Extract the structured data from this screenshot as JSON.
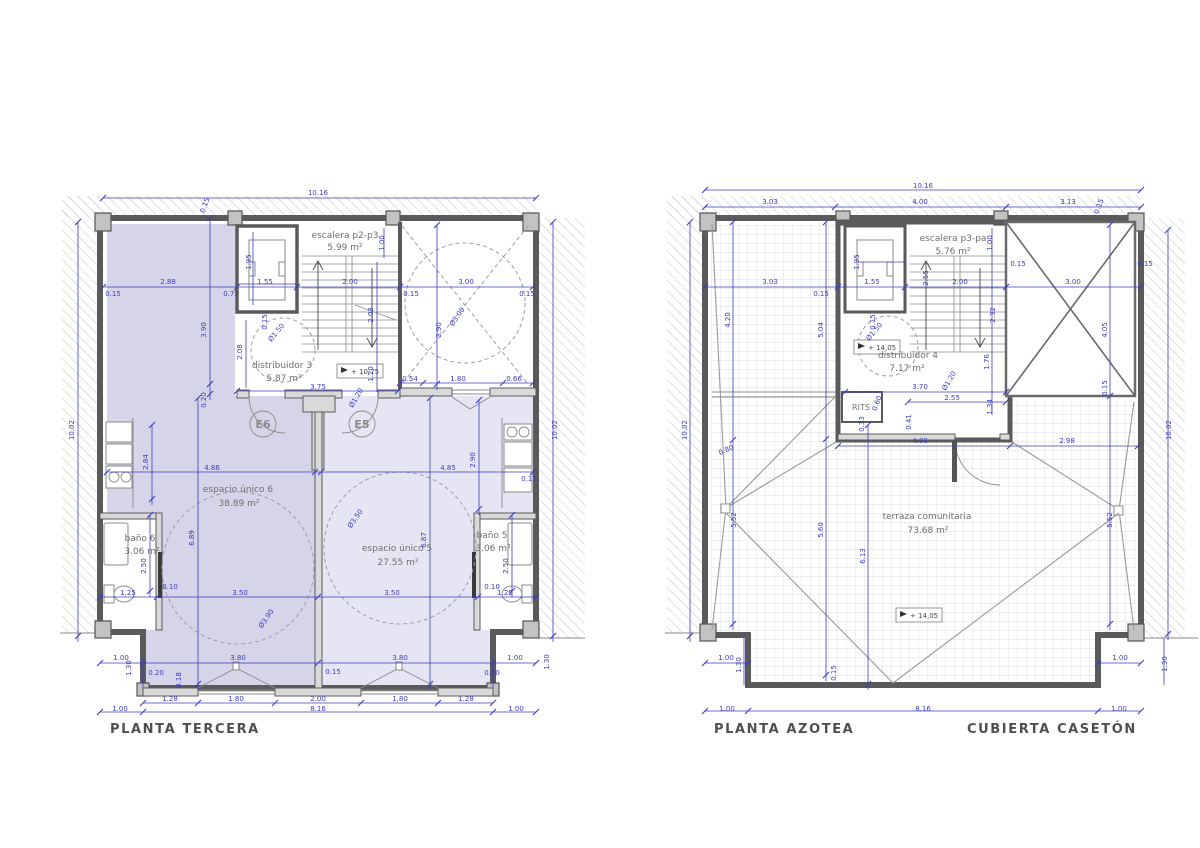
{
  "titles": {
    "left": "PLANTA TERCERA",
    "right": "PLANTA AZOTEA",
    "right2": "CUBIERTA CASETÓN"
  },
  "colors": {
    "dimension": "#3c3cc0",
    "wall": "#5a5a5a",
    "room_fill_6": "#d6d4e9",
    "room_fill_5": "#e6e5f3"
  },
  "plans": {
    "left": {
      "rooms": [
        {
          "name": "escalera p2-p3",
          "area": "5.99 m²"
        },
        {
          "name": "distribuidor 3",
          "area": "5.87 m²"
        },
        {
          "name": "espacio único 6",
          "area": "38.89 m²"
        },
        {
          "name": "espacio único 5",
          "area": "27.55 m²"
        },
        {
          "name": "baño 6",
          "area": "3.06 m²"
        },
        {
          "name": "baño 5",
          "area": "3.06 m²"
        }
      ],
      "doors": [
        {
          "label": "E6"
        },
        {
          "label": "E5"
        }
      ],
      "level_marker": "+ 10,75",
      "dims": [
        {
          "t": "10.16",
          "x": 318,
          "y": 195
        },
        {
          "t": "0.15",
          "x": 207,
          "y": 206,
          "r": -70
        },
        {
          "t": "2.88",
          "x": 168,
          "y": 284
        },
        {
          "t": "0.15",
          "x": 113,
          "y": 296
        },
        {
          "t": "1.55",
          "x": 265,
          "y": 284
        },
        {
          "t": "0.75",
          "x": 231,
          "y": 296
        },
        {
          "t": "1.95",
          "x": 251,
          "y": 262,
          "r": -90
        },
        {
          "t": "0.15",
          "x": 267,
          "y": 322,
          "r": -90
        },
        {
          "t": "2.00",
          "x": 350,
          "y": 284
        },
        {
          "t": "3.00",
          "x": 466,
          "y": 284
        },
        {
          "t": "0.15",
          "x": 527,
          "y": 296
        },
        {
          "t": "0.15",
          "x": 411,
          "y": 296
        },
        {
          "t": "1.00",
          "x": 384,
          "y": 243,
          "r": -90
        },
        {
          "t": "3.90",
          "x": 206,
          "y": 330,
          "r": -90
        },
        {
          "t": "0.20",
          "x": 206,
          "y": 400,
          "r": -90
        },
        {
          "t": "3.90",
          "x": 441,
          "y": 330,
          "r": -90
        },
        {
          "t": "2.03",
          "x": 373,
          "y": 315,
          "r": -90
        },
        {
          "t": "2.08",
          "x": 242,
          "y": 352,
          "r": -90
        },
        {
          "t": "Ø1.50",
          "x": 278,
          "y": 334,
          "r": -50
        },
        {
          "t": "Ø3.00",
          "x": 459,
          "y": 318,
          "r": -55
        },
        {
          "t": "3.75",
          "x": 318,
          "y": 389
        },
        {
          "t": "1.20",
          "x": 373,
          "y": 374,
          "r": -90
        },
        {
          "t": "Ø1.20",
          "x": 358,
          "y": 399,
          "r": -60
        },
        {
          "t": "0.54",
          "x": 410,
          "y": 381
        },
        {
          "t": "1.80",
          "x": 458,
          "y": 381
        },
        {
          "t": "0.66",
          "x": 514,
          "y": 381
        },
        {
          "t": "10.02",
          "x": 74,
          "y": 430,
          "r": -90
        },
        {
          "t": "10.02",
          "x": 557,
          "y": 430,
          "r": -90
        },
        {
          "t": "2.84",
          "x": 148,
          "y": 462,
          "r": -90
        },
        {
          "t": "2.90",
          "x": 475,
          "y": 460,
          "r": -90
        },
        {
          "t": "4.86",
          "x": 212,
          "y": 470
        },
        {
          "t": "4.85",
          "x": 448,
          "y": 470
        },
        {
          "t": "0.15",
          "x": 529,
          "y": 481
        },
        {
          "t": "6.89",
          "x": 194,
          "y": 538,
          "r": -90
        },
        {
          "t": "6.87",
          "x": 426,
          "y": 540,
          "r": -90
        },
        {
          "t": "Ø3.50",
          "x": 357,
          "y": 520,
          "r": -55
        },
        {
          "t": "Ø3.90",
          "x": 268,
          "y": 620,
          "r": -55
        },
        {
          "t": "2.50",
          "x": 146,
          "y": 566,
          "r": -90
        },
        {
          "t": "2.50",
          "x": 508,
          "y": 566,
          "r": -90
        },
        {
          "t": "0.10",
          "x": 170,
          "y": 589
        },
        {
          "t": "0.10",
          "x": 492,
          "y": 589
        },
        {
          "t": "1.25",
          "x": 128,
          "y": 595
        },
        {
          "t": "1.25",
          "x": 505,
          "y": 595
        },
        {
          "t": "3.50",
          "x": 240,
          "y": 595
        },
        {
          "t": "3.50",
          "x": 392,
          "y": 595
        },
        {
          "t": "1.00",
          "x": 121,
          "y": 660
        },
        {
          "t": "3.80",
          "x": 238,
          "y": 660
        },
        {
          "t": "3.80",
          "x": 400,
          "y": 660
        },
        {
          "t": "1.00",
          "x": 515,
          "y": 660
        },
        {
          "t": "0.20",
          "x": 156,
          "y": 675
        },
        {
          "t": "0.18",
          "x": 181,
          "y": 680,
          "r": -90
        },
        {
          "t": "0.15",
          "x": 333,
          "y": 674
        },
        {
          "t": "0.20",
          "x": 492,
          "y": 675
        },
        {
          "t": "1.30",
          "x": 131,
          "y": 668,
          "r": -90
        },
        {
          "t": "1.30",
          "x": 549,
          "y": 662,
          "r": -90
        },
        {
          "t": "1.28",
          "x": 170,
          "y": 701
        },
        {
          "t": "1.80",
          "x": 236,
          "y": 701
        },
        {
          "t": "2.00",
          "x": 318,
          "y": 701
        },
        {
          "t": "1.80",
          "x": 400,
          "y": 701
        },
        {
          "t": "1.28",
          "x": 466,
          "y": 701
        },
        {
          "t": "1.00",
          "x": 120,
          "y": 711
        },
        {
          "t": "8.16",
          "x": 318,
          "y": 711
        },
        {
          "t": "1.00",
          "x": 516,
          "y": 711
        }
      ]
    },
    "right": {
      "rooms": [
        {
          "name": "escalera p3-pa",
          "area": "5.76 m²"
        },
        {
          "name": "distribuidor 4",
          "area": "7.17 m²"
        },
        {
          "name": "RITS",
          "area": ""
        },
        {
          "name": "terraza comunitaria",
          "area": "73.68 m²"
        }
      ],
      "level_marker": "+ 14,05",
      "level_marker_2": "+ 14,05",
      "dims": [
        {
          "t": "10.16",
          "x": 923,
          "y": 188
        },
        {
          "t": "3.03",
          "x": 770,
          "y": 204
        },
        {
          "t": "4.00",
          "x": 920,
          "y": 204
        },
        {
          "t": "3.13",
          "x": 1068,
          "y": 204
        },
        {
          "t": "0.15",
          "x": 1101,
          "y": 207,
          "r": -70
        },
        {
          "t": "3.03",
          "x": 770,
          "y": 284
        },
        {
          "t": "0.15",
          "x": 821,
          "y": 296
        },
        {
          "t": "1.55",
          "x": 872,
          "y": 284
        },
        {
          "t": "1.95",
          "x": 859,
          "y": 262,
          "r": -90
        },
        {
          "t": "0.15",
          "x": 875,
          "y": 322,
          "r": -90
        },
        {
          "t": "2.00",
          "x": 960,
          "y": 284
        },
        {
          "t": "2.55",
          "x": 928,
          "y": 278,
          "r": -90
        },
        {
          "t": "1.00",
          "x": 992,
          "y": 243,
          "r": -90
        },
        {
          "t": "0.15",
          "x": 1018,
          "y": 266
        },
        {
          "t": "3.00",
          "x": 1073,
          "y": 284
        },
        {
          "t": "0.15",
          "x": 1145,
          "y": 266
        },
        {
          "t": "10.02",
          "x": 687,
          "y": 430,
          "r": -90
        },
        {
          "t": "10.02",
          "x": 1171,
          "y": 430,
          "r": -90
        },
        {
          "t": "4.20",
          "x": 730,
          "y": 320,
          "r": -90
        },
        {
          "t": "5.52",
          "x": 736,
          "y": 520,
          "r": -90
        },
        {
          "t": "5.52",
          "x": 1112,
          "y": 520,
          "r": -90
        },
        {
          "t": "0.80",
          "x": 727,
          "y": 452,
          "r": -25
        },
        {
          "t": "5.04",
          "x": 823,
          "y": 330,
          "r": -90
        },
        {
          "t": "5.60",
          "x": 823,
          "y": 530,
          "r": -90
        },
        {
          "t": "6.13",
          "x": 865,
          "y": 556,
          "r": -90
        },
        {
          "t": "0.15",
          "x": 836,
          "y": 673,
          "r": -90
        },
        {
          "t": "4.05",
          "x": 1107,
          "y": 330,
          "r": -90
        },
        {
          "t": "0.15",
          "x": 1107,
          "y": 388,
          "r": -90
        },
        {
          "t": "2.32",
          "x": 995,
          "y": 315,
          "r": -90
        },
        {
          "t": "1.76",
          "x": 989,
          "y": 362,
          "r": -90
        },
        {
          "t": "1.34",
          "x": 992,
          "y": 407,
          "r": -90
        },
        {
          "t": "Ø1.50",
          "x": 876,
          "y": 333,
          "r": -50
        },
        {
          "t": "Ø1.20",
          "x": 951,
          "y": 382,
          "r": -60
        },
        {
          "t": "3.70",
          "x": 920,
          "y": 389
        },
        {
          "t": "2.55",
          "x": 952,
          "y": 400
        },
        {
          "t": "0.60",
          "x": 879,
          "y": 404,
          "r": -70
        },
        {
          "t": "0.33",
          "x": 864,
          "y": 424,
          "r": -90
        },
        {
          "t": "0.41",
          "x": 911,
          "y": 422,
          "r": -90
        },
        {
          "t": "4.00",
          "x": 920,
          "y": 443
        },
        {
          "t": "2.98",
          "x": 1067,
          "y": 443
        },
        {
          "t": "1.00",
          "x": 726,
          "y": 660
        },
        {
          "t": "1.30",
          "x": 741,
          "y": 665,
          "r": -90
        },
        {
          "t": "1.00",
          "x": 1120,
          "y": 660
        },
        {
          "t": "1.30",
          "x": 1167,
          "y": 664,
          "r": -90
        },
        {
          "t": "1.00",
          "x": 727,
          "y": 711
        },
        {
          "t": "8.16",
          "x": 923,
          "y": 711
        },
        {
          "t": "1.00",
          "x": 1119,
          "y": 711
        }
      ]
    }
  }
}
